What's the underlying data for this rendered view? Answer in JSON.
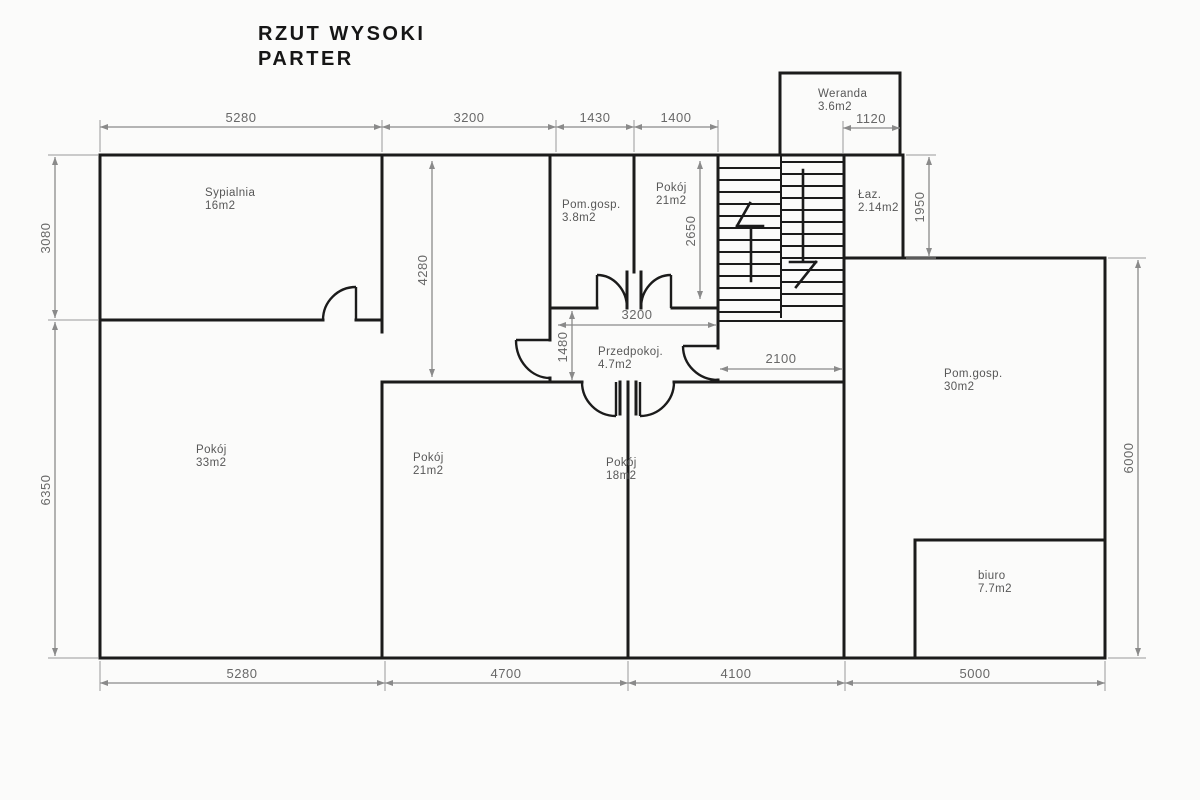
{
  "title": {
    "line1": "RZUT WYSOKI",
    "line2": "PARTER"
  },
  "rooms": [
    {
      "name": "Sypialnia",
      "area": "16m2"
    },
    {
      "name": "Pokój",
      "area": "33m2"
    },
    {
      "name": "Pom.gosp.",
      "area": "3.8m2"
    },
    {
      "name": "Pokój",
      "area": "21m2"
    },
    {
      "name": "Weranda",
      "area": "3.6m2"
    },
    {
      "name": "Łaz.",
      "area": "2.14m2"
    },
    {
      "name": "Przedpokoj.",
      "area": "4.7m2"
    },
    {
      "name": "Pokój",
      "area": "21m2"
    },
    {
      "name": "Pokój",
      "area": "18m2"
    },
    {
      "name": "Pom.gosp.",
      "area": "30m2"
    },
    {
      "name": "biuro",
      "area": "7.7m2"
    }
  ],
  "dims": {
    "top": [
      "5280",
      "3200",
      "1430",
      "1400"
    ],
    "weranda": "1120",
    "bottom": [
      "5280",
      "4700",
      "4100",
      "5000"
    ],
    "left": [
      "3080",
      "6350"
    ],
    "right": [
      "1950",
      "6000"
    ],
    "inner": {
      "w4280": "4280",
      "h2650": "2650",
      "hall_w": "3200",
      "hall_h": "1480",
      "corridor": "2100"
    }
  },
  "colors": {
    "wall": "#1b1b1b",
    "dimension": "#8a8a8a",
    "label": "#575757",
    "background": "#fbfbfa"
  }
}
